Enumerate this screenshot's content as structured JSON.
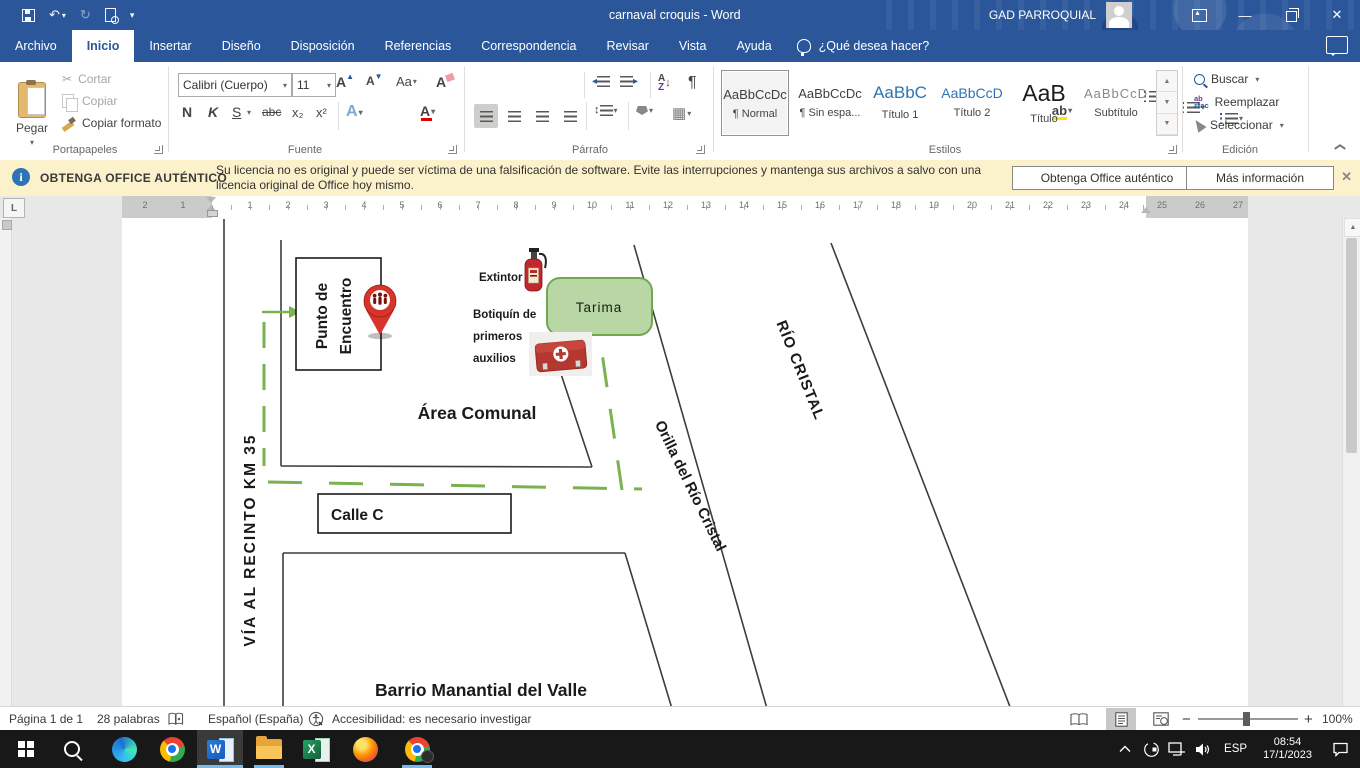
{
  "titlebar": {
    "title": "carnaval croquis  -  Word",
    "account_name": "GAD PARROQUIAL"
  },
  "menu": {
    "tabs": [
      "Archivo",
      "Inicio",
      "Insertar",
      "Diseño",
      "Disposición",
      "Referencias",
      "Correspondencia",
      "Revisar",
      "Vista",
      "Ayuda"
    ],
    "active_tab": "Inicio",
    "tell_me": "¿Qué desea hacer?"
  },
  "ribbon": {
    "clipboard": {
      "group": "Portapapeles",
      "paste": "Pegar",
      "cut": "Cortar",
      "copy": "Copiar",
      "format_painter": "Copiar formato"
    },
    "font": {
      "group": "Fuente",
      "family": "Calibri (Cuerpo)",
      "size": "11",
      "bold": "N",
      "italic": "K",
      "underline": "S",
      "strikethrough": "abc",
      "subscript": "x₂",
      "superscript": "x²",
      "grow": "A",
      "shrink": "A",
      "change_case": "Aa",
      "clear_format": "A",
      "text_effects": "A",
      "highlight": "ab",
      "font_color": "A"
    },
    "paragraph": {
      "group": "Párrafo",
      "sort_a": "A",
      "sort_z": "Z",
      "pilcrow": "¶"
    },
    "styles": {
      "group": "Estilos",
      "items": [
        {
          "preview": "AaBbCcDc",
          "label": "¶ Normal"
        },
        {
          "preview": "AaBbCcDc",
          "label": "¶ Sin espa..."
        },
        {
          "preview": "AaBbC",
          "label": "Título 1"
        },
        {
          "preview": "AaBbCcD",
          "label": "Título 2"
        },
        {
          "preview": "AaB",
          "label": "Título"
        },
        {
          "preview": "AaBbCcD",
          "label": "Subtítulo"
        }
      ]
    },
    "editing": {
      "group": "Edición",
      "find": "Buscar",
      "replace": "Reemplazar",
      "select": "Seleccionar"
    }
  },
  "banner": {
    "title": "OBTENGA OFFICE AUTÉNTICO",
    "message_line1": "Su licencia no es original y puede ser víctima de una falsificación de software. Evite las interrupciones y mantenga sus archivos a salvo con una",
    "message_line2": "licencia original de Office hoy mismo.",
    "button_get": "Obtenga Office auténtico",
    "button_info": "Más información",
    "info_glyph": "i"
  },
  "ruler": {
    "margin_numbers": [
      "2",
      "1"
    ],
    "cm": [
      "1",
      "2",
      "3",
      "4",
      "5",
      "6",
      "7",
      "8",
      "9",
      "10",
      "11",
      "12",
      "13",
      "14",
      "15",
      "16",
      "17",
      "18",
      "19",
      "20",
      "21",
      "22",
      "23",
      "24",
      "25",
      "26",
      "27"
    ]
  },
  "map": {
    "labels": {
      "punto_line1": "Punto de",
      "punto_line2": "Encuentro",
      "extintor": "Extintor",
      "tarima": "Tarima",
      "botiquin_line1": "Botiquín de",
      "botiquin_line2": "primeros",
      "botiquin_line3": "auxilios",
      "area_comunal": "Área Comunal",
      "calle": "Calle C",
      "via": "VÍA AL RECINTO KM 35",
      "orilla": "Orilla del Río Cristal",
      "rio": "RÍO CRISTAL",
      "barrio": "Barrio Manantial del Valle"
    },
    "colors": {
      "route_green": "#79b24e",
      "tarima_fill": "#b9d7a5",
      "tarima_border": "#6fa84f",
      "pin_red": "#d7352b",
      "line_dark": "#3d3d3d",
      "botiquin_red": "#b53830"
    }
  },
  "statusbar": {
    "page": "Página 1 de 1",
    "words": "28 palabras",
    "language": "Español (España)",
    "accessibility": "Accesibilidad: es necesario investigar",
    "zoom_level": "100%",
    "zoom_minus": "−",
    "zoom_plus": "+"
  },
  "taskbar": {
    "tray": {
      "language": "ESP",
      "time": "08:54",
      "date": "17/1/2023"
    }
  }
}
